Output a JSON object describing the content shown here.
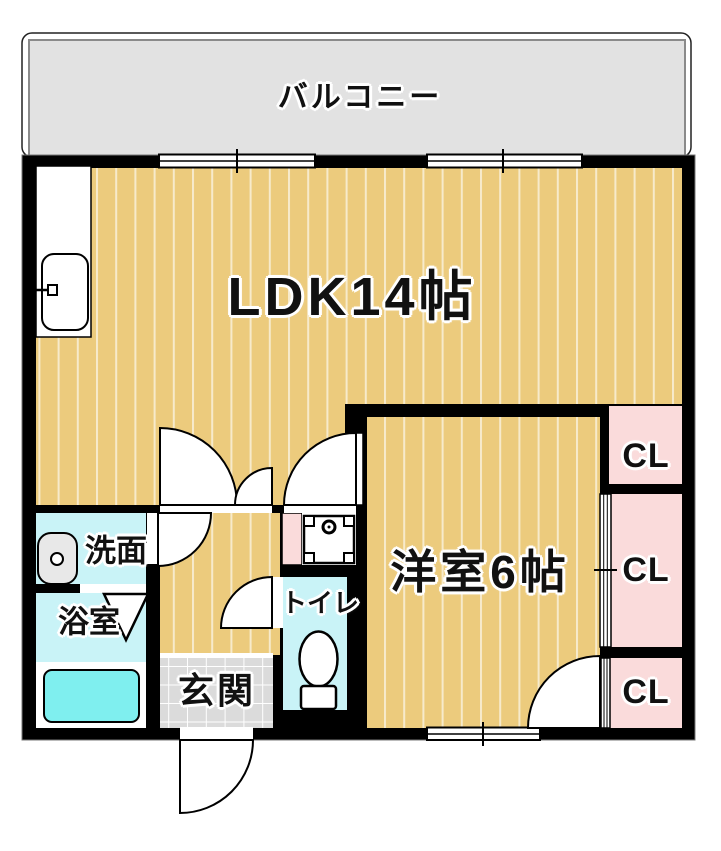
{
  "document_type": "apartment-floorplan",
  "labels": {
    "balcony": "バルコニー",
    "ldk": "LDK14帖",
    "western_room": "洋室6帖",
    "washroom": "洗面",
    "bathroom": "浴室",
    "toilet": "トイレ",
    "entrance": "玄関",
    "closets": [
      "CL",
      "CL",
      "CL"
    ]
  },
  "colors": {
    "wall_black": "#000000",
    "wood_floor": "#ECCB7D",
    "balcony_gray": "#E2E2E2",
    "tile_gray": "#DBDBDB",
    "room_cyan": "#C9F3F7",
    "bathtub_cyan": "#7FEFEF",
    "closet_pink": "#FADBDB",
    "fixture_white": "#FFFFFF",
    "basin_gray": "#E8E8E8"
  }
}
